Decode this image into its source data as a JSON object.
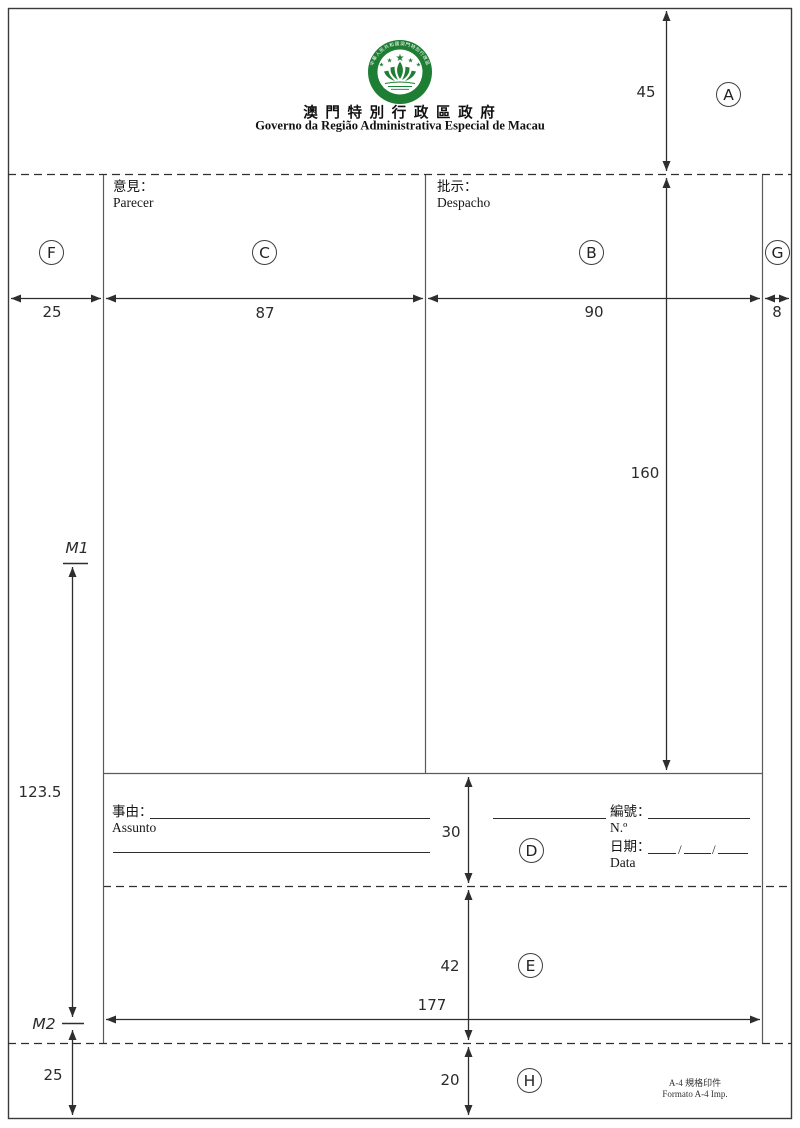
{
  "header": {
    "title_zh": "澳 門 特 別 行 政 區 政 府",
    "title_pt": "Governo da Região Administrativa Especial de Macau"
  },
  "emblem": {
    "ring_top": "中華人民共和國澳門特別行政區",
    "ring_bottom": "MACAU",
    "star": "★",
    "green": "#1e7e34"
  },
  "fields": {
    "parecer": {
      "zh": "意見：",
      "pt": "Parecer"
    },
    "despacho": {
      "zh": "批示：",
      "pt": "Despacho"
    },
    "assunto": {
      "zh": "事由：",
      "pt": "Assunto"
    },
    "numero": {
      "zh": "編號：",
      "pt": "N.º"
    },
    "data": {
      "zh": "日期：",
      "pt": "Data",
      "slash": "/"
    }
  },
  "regions": {
    "a": "A",
    "b": "B",
    "c": "C",
    "d": "D",
    "e": "E",
    "f": "F",
    "g": "G",
    "h": "H"
  },
  "markers": {
    "m1": "M1",
    "m2": "M2"
  },
  "dims": {
    "margin_top": "45",
    "margin_left": "25",
    "col_c": "87",
    "col_b": "90",
    "margin_right": "8",
    "height_cb": "160",
    "span_m": "123.5",
    "height_d": "30",
    "height_e": "42",
    "width_form": "177",
    "height_h": "20",
    "margin_bottom": "25"
  },
  "footer": {
    "line1": "A-4 規格印件",
    "line2": "Formato A-4 Imp."
  }
}
